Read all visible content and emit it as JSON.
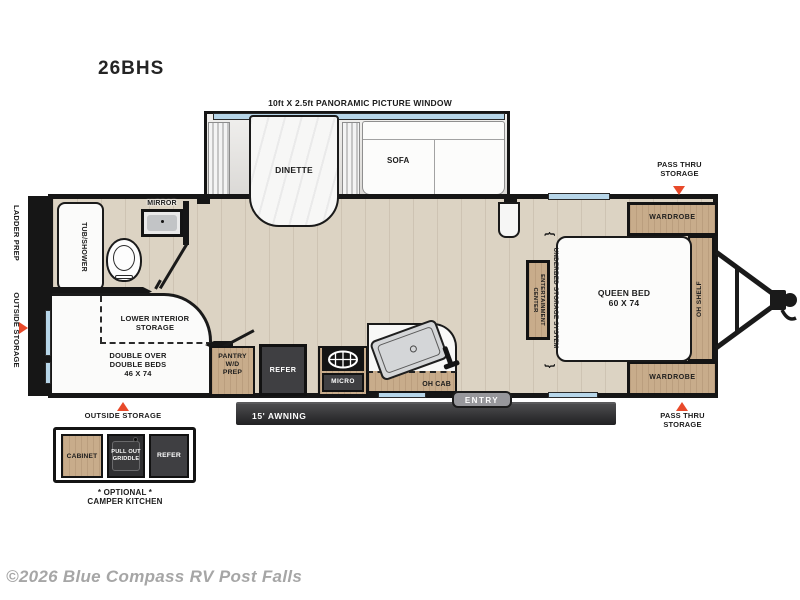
{
  "title": "26BHS",
  "footer": {
    "copyright": "©2026 Blue Compass RV Post Falls"
  },
  "colors": {
    "accent": "#e8492a",
    "window": "#b7d6e9",
    "wood_cabinet": "#c8ac8b",
    "appliance": "#3f3f42",
    "wall": "#161616",
    "floor": "#dcd3c3"
  },
  "icons": {
    "brace_top": "{",
    "brace_bottom": "}"
  },
  "floorplan": {
    "slideout": {
      "window_label": "10ft X 2.5ft PANORAMIC PICTURE WINDOW",
      "dinette": "DINETTE",
      "sofa": "SOFA"
    },
    "exterior_left": {
      "ladder_prep": "LADDER PREP",
      "outside_storage": "OUTSIDE STORAGE"
    },
    "bathroom": {
      "mirror": "MIRROR",
      "tub_shower": "TUB/SHOWER"
    },
    "bunk": {
      "lower_interior_storage": "LOWER INTERIOR\nSTORAGE",
      "double_beds": "DOUBLE OVER\nDOUBLE BEDS\n46 X 74"
    },
    "kitchen": {
      "pantry": "PANTRY\nW/D\nPREP",
      "refer": "REFER",
      "micro": "MICRO",
      "oh_cab": "OH CAB"
    },
    "bedroom": {
      "wardrobe_top": "WARDROBE",
      "wardrobe_bottom": "WARDROBE",
      "queen_bed": "QUEEN BED\n60 X 74",
      "oh_shelf": "OH SHELF",
      "underbed_storage": "UNDERBED STORAGE SYSTEM",
      "entertainment_center": "ENTERTAINMENT\nCENTER"
    },
    "exterior_right": {
      "pass_thru_top": "PASS THRU\nSTORAGE",
      "pass_thru_bottom": "PASS THRU\nSTORAGE"
    },
    "bottom": {
      "entry": "ENTRY",
      "awning": "15' AWNING",
      "outside_storage": "OUTSIDE STORAGE"
    },
    "camper_kitchen": {
      "cabinet": "CABINET",
      "griddle": "PULL OUT\nGRIDDLE",
      "refer": "REFER",
      "caption": "* OPTIONAL *\nCAMPER KITCHEN"
    }
  }
}
